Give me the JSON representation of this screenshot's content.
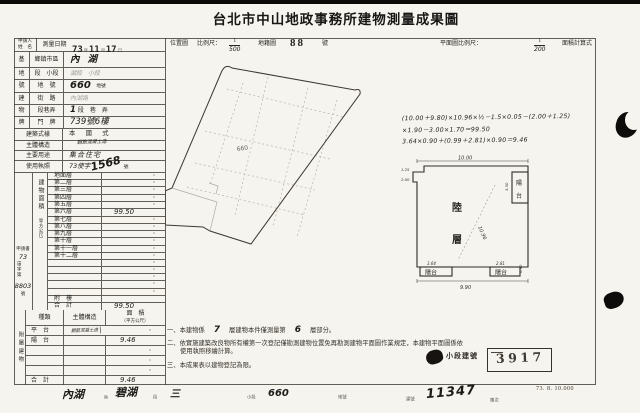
{
  "title": "台北市中山地政事務所建物測量成果圖",
  "header": {
    "applicant_l1": "申請人",
    "applicant_l2": "姓　名",
    "survey_label": "測量日期",
    "date_year": "73",
    "date_y": "年",
    "date_month": "11",
    "date_m": "月",
    "date_day": "17",
    "date_d": "日",
    "loc_label": "位置圖",
    "loc_scale_label": "比例尺：",
    "loc_num": "1",
    "loc_den": "500",
    "cad_label": "地籍圖",
    "cad_no": "88",
    "cad_unit": "號",
    "plan_scale_label": "平面圖比例尺：",
    "plan_num": "1",
    "plan_den": "200",
    "formula_label": "面積計算式"
  },
  "site": {
    "stub1": "基",
    "stub2": "地",
    "stub3": "號",
    "district_label": "鄉鎮市區",
    "district_value": "內湖",
    "section_label": "段　小段",
    "section_value": "湖段　小段",
    "parcel_label": "地　號",
    "parcel_value": "660",
    "parcel_unit": "地號"
  },
  "address": {
    "stub1": "建",
    "stub2": "物",
    "stub3": "牌",
    "street_label": "街　路",
    "street_value": "內湖路",
    "lane_label": "段巷弄",
    "lane_hand": "1",
    "lane_print": "段　巷　弄",
    "house_label": "門　牌",
    "house_value": "739號6樓"
  },
  "style": {
    "style_label": "建築式樣",
    "style_value": "本　國　式",
    "structure_label": "主體構造",
    "structure_value": "鋼筋混凝土造",
    "use_label": "主要用途",
    "use_value": "集合住宅",
    "license_label": "使用執照",
    "license_pre": "73使字",
    "license_no": "1568",
    "license_unit": "號"
  },
  "floors": {
    "stub_main": "建物面積",
    "stub_sub": "（平方公尺）",
    "rows": [
      {
        "label": "地面層",
        "value": "·"
      },
      {
        "label": "第二層",
        "value": "·"
      },
      {
        "label": "第三層",
        "value": "·"
      },
      {
        "label": "第四層",
        "value": "·"
      },
      {
        "label": "第五層",
        "value": "·"
      },
      {
        "label": "第六層",
        "value": "99.50",
        "hand": true
      },
      {
        "label": "第七層",
        "value": "·"
      },
      {
        "label": "第八層",
        "value": "·"
      },
      {
        "label": "第九層",
        "value": "·"
      },
      {
        "label": "第十層",
        "value": "·"
      },
      {
        "label": "第十一層",
        "value": "·"
      },
      {
        "label": "第十二層",
        "value": "·"
      },
      {
        "label": "",
        "value": "·"
      },
      {
        "label": "",
        "value": "·"
      },
      {
        "label": "",
        "value": "·"
      },
      {
        "label": "",
        "value": "·"
      },
      {
        "label": "",
        "value": "·"
      },
      {
        "label": "附　樓",
        "value": ""
      },
      {
        "label": "合　計",
        "value": "99.50",
        "hand": true
      }
    ]
  },
  "application": {
    "l1": "申請書",
    "no1": "73",
    "l2": "宙字第",
    "no2": "8803",
    "l3": "號"
  },
  "annex": {
    "stub": "附屬建物",
    "h_kind": "種類",
    "h_structure": "主體構造",
    "h_area1": "面　積",
    "h_area2": "（平方公尺）",
    "rows": [
      {
        "kind": "平　台",
        "structure": "鋼筋混凝土造",
        "area": "·",
        "structure_hand": true
      },
      {
        "kind": "陽　台",
        "structure": "",
        "area": "9.46",
        "hand": true
      },
      {
        "kind": "",
        "structure": "",
        "area": "·"
      },
      {
        "kind": "",
        "structure": "",
        "area": "·"
      },
      {
        "kind": "",
        "structure": "",
        "area": "·"
      },
      {
        "kind": "合　計",
        "structure": "",
        "area": "9.46",
        "hand": true
      }
    ]
  },
  "notes": {
    "n1_no": "一、",
    "n1_a": "本建物係",
    "n1_num1": "7",
    "n1_b": "層建物本件僅測量第",
    "n1_num2": "6",
    "n1_c": "層部分。",
    "n2": "二、依實施建築改良物所有權第一次登記僅勘測建物位置免再勘測建物平面圖作業規定，本建物平面圖係依使用執照移繪計算。",
    "n3": "三、本成果表以建物登記為限。"
  },
  "stamp": {
    "label": "小段建號",
    "number": "3917"
  },
  "map": {
    "parcel": "660"
  },
  "plan": {
    "formula1": "(10.00＋9.80)×10.96×½－1.5×0.05－(2.00＋1.25)",
    "formula2": "×1.90－3.00×1.70＝99.50",
    "formula3": "3.64×0.90＋(0.99＋2.81)×0.90＝9.46",
    "room1": "陸",
    "room2": "層",
    "dim_top": "10.00",
    "dim_bottom": "9.90",
    "dim_diag": "10.96",
    "balcony_v1": "陽",
    "balcony_v2": "台",
    "balcony_bl": "陽台",
    "balcony_br": "陽台",
    "dim_notch1": "1.25",
    "dim_notch2": "2.00",
    "dim_bl": "3.64",
    "dim_br": "2.81",
    "dim_side_r": "0.90",
    "dim_tr": "3.50"
  },
  "footer": {
    "district": "內湖",
    "district_u": "區",
    "section": "碧湖",
    "section_u": "段",
    "subsection": "三",
    "subsection_u": "小段",
    "parcel": "660",
    "parcel_u": "地號",
    "bldg_label": "建號",
    "bldg_no": "11347",
    "bldg_u": "棟次",
    "print_code": "73. 8. 10.000"
  }
}
